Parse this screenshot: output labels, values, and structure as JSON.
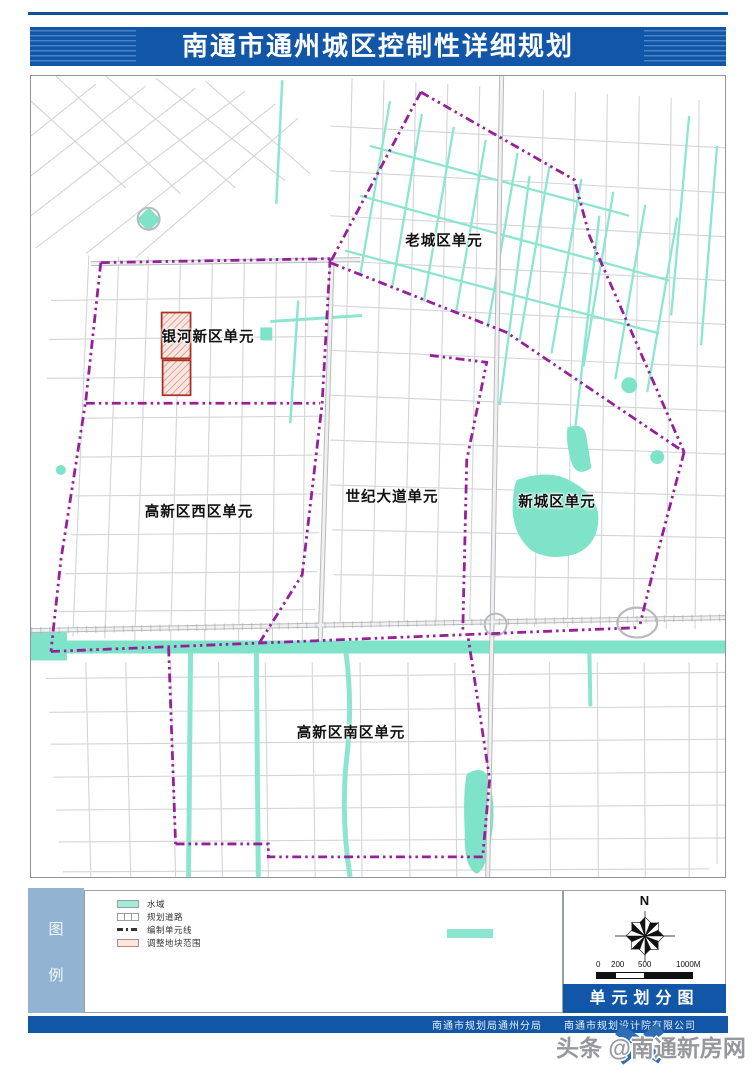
{
  "header": {
    "title": "南通市通州城区控制性详细规划"
  },
  "map": {
    "units": [
      {
        "name": "老城区单元"
      },
      {
        "name": "银河新区单元"
      },
      {
        "name": "高新区西区单元"
      },
      {
        "name": "世纪大道单元"
      },
      {
        "name": "新城区单元"
      },
      {
        "name": "高新区南区单元"
      }
    ]
  },
  "legend": {
    "strip_chars": [
      "图",
      "例"
    ],
    "items": [
      {
        "label": "水域"
      },
      {
        "label": "规划道路"
      },
      {
        "label": "编制单元线"
      },
      {
        "label": "调整地块范围"
      }
    ]
  },
  "map_info": {
    "north_label": "N",
    "scale_ticks": [
      "0",
      "200",
      "500",
      "1000M"
    ],
    "map_name": "单元划分图"
  },
  "footer": {
    "agency_left": "南通市规划局通州分局",
    "agency_right": "南通市规划设计院有限公司"
  },
  "watermark": {
    "text": "头条 @南通新房网"
  },
  "colors": {
    "banner_blue": "#1256a7",
    "boundary_purple": "#96209a",
    "water_teal": "#7ee3c8",
    "adjust_red": "#a93226"
  }
}
